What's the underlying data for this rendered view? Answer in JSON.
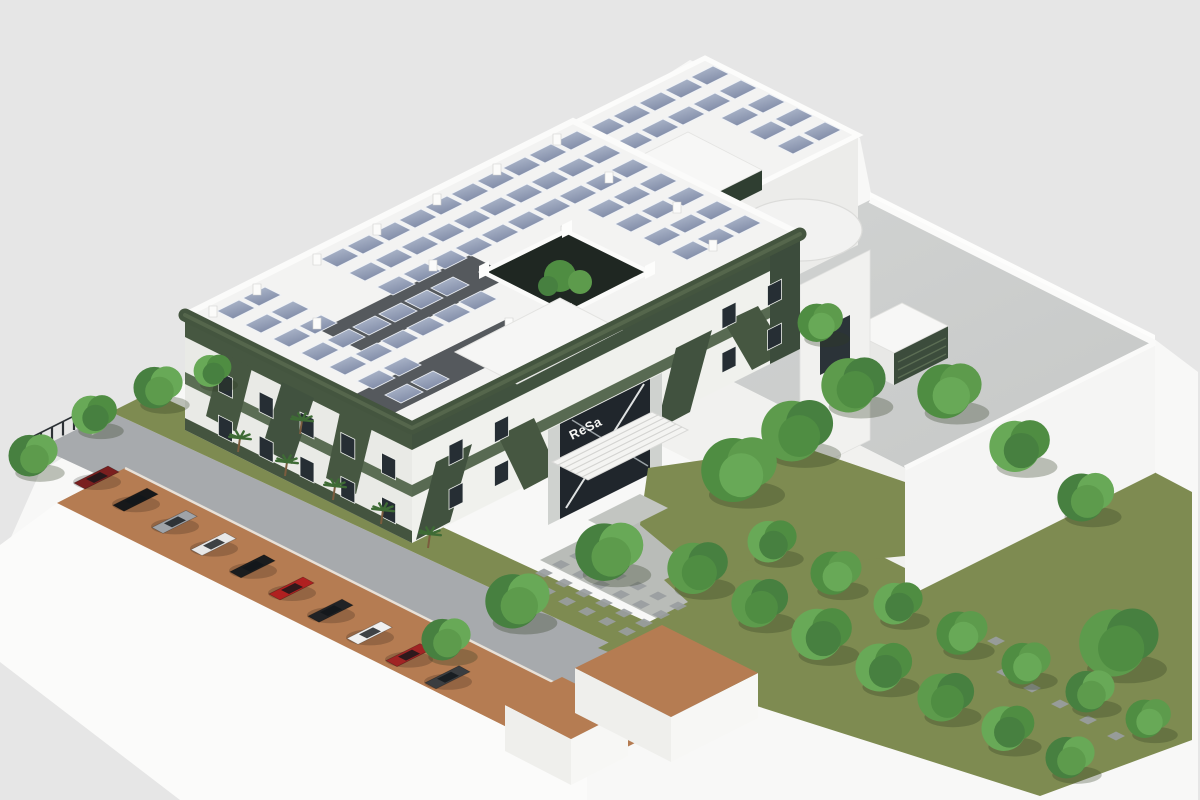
{
  "scene": {
    "type": "3d-architectural-rendering",
    "view": "isometric-aerial",
    "description": "Isometric aerial rendering of a two-story eco office building with a dark-green lattice facade, rooftop photovoltaic array, central courtyard atrium, flat-roof terrace annex, tree-lined lawns, stepping-stone paths and a parking strip under a terracotta canopy",
    "background_color": "#e6e6e6",
    "ground_color": "#f8f8f7"
  },
  "building": {
    "sign_text": "ReSa",
    "floors_visible": 2,
    "facade_green": "#41523f",
    "facade_green_light": "#5b6d54",
    "wall_white": "#f0f1ed",
    "roof_white": "#f3f3f2",
    "dark_roof_strip": "#55595d",
    "glass_dark": "#262e34",
    "parapet_white": "#fbfbfa"
  },
  "solar": {
    "frame_color": "#eef1f6",
    "cell_light": "#b6c0d2",
    "cell_dark": "#7e89a5",
    "grids": [
      {
        "id": "main",
        "origin": [
          573,
          121
        ],
        "a_rows": [
          6,
          20,
          34,
          48,
          62,
          76,
          90
        ],
        "b_start": 4,
        "b_end": 180,
        "b_step": 13,
        "pw": 11,
        "pd": 8,
        "skips": [
          {
            "a": [
              45,
              100
            ],
            "b": [
              48,
              106
            ]
          },
          {
            "a": [
              76,
              118
            ],
            "b": [
              86,
              152
            ]
          },
          {
            "a": [
              0,
              40
            ],
            "b": [
              138,
              152
            ]
          }
        ]
      },
      {
        "id": "wing",
        "origin": [
          705,
          58
        ],
        "a_rows": [
          6,
          20,
          34,
          48,
          62
        ],
        "b_start": 2,
        "b_end": 72,
        "b_step": 13,
        "pw": 11,
        "pd": 8,
        "skips": [
          {
            "a": [
              28,
              75
            ],
            "b": [
              36,
              84
            ]
          }
        ]
      }
    ]
  },
  "terrace": {
    "deck_color": "#cdcfce",
    "louver_color": "#3c4c3c",
    "wall_color": "#f5f5f4"
  },
  "landscape": {
    "lawn_color": "#7e8b51",
    "paving_color": "#a7aaad",
    "forecourt_color": "#b9bcb8",
    "canopy_color": "#b57c52",
    "stone_color": "#999da0",
    "tree_greens": [
      "#5d9b4c",
      "#4f8d42",
      "#68a957",
      "#478040"
    ],
    "tree_shadow": "#2f3b22",
    "trunk_color": "#7b5c3e",
    "palm_green": "#3e6b35"
  },
  "trees": [
    [
      35,
      470,
      26
    ],
    [
      96,
      428,
      24
    ],
    [
      160,
      402,
      26
    ],
    [
      214,
      382,
      20
    ],
    [
      742,
      492,
      40
    ],
    [
      800,
      452,
      38
    ],
    [
      856,
      404,
      34
    ],
    [
      822,
      336,
      24
    ],
    [
      612,
      572,
      36
    ],
    [
      520,
      620,
      34
    ],
    [
      448,
      654,
      26
    ],
    [
      700,
      586,
      32
    ],
    [
      762,
      620,
      30
    ],
    [
      824,
      652,
      32
    ],
    [
      886,
      684,
      30
    ],
    [
      948,
      714,
      30
    ],
    [
      1010,
      744,
      28
    ],
    [
      1072,
      772,
      26
    ],
    [
      774,
      556,
      26
    ],
    [
      838,
      588,
      27
    ],
    [
      900,
      618,
      26
    ],
    [
      964,
      648,
      27
    ],
    [
      1028,
      678,
      26
    ],
    [
      1092,
      706,
      26
    ],
    [
      1150,
      732,
      24
    ],
    [
      952,
      410,
      34
    ],
    [
      1022,
      464,
      32
    ],
    [
      1088,
      514,
      30
    ],
    [
      1122,
      666,
      42
    ]
  ],
  "palms": [
    [
      238,
      452
    ],
    [
      285,
      476
    ],
    [
      333,
      500
    ],
    [
      381,
      524
    ],
    [
      428,
      548
    ],
    [
      300,
      434
    ]
  ],
  "cars": {
    "start": [
      95,
      478
    ],
    "step": [
      39,
      22.2
    ],
    "colors": [
      "#7a1f1f",
      "#17181a",
      "#9fa3a8",
      "#e8e8e8",
      "#1a1c1e",
      "#b02020",
      "#202225",
      "#f0f0f0",
      "#a02424",
      "#3a3d40"
    ]
  },
  "windows": {
    "sw": {
      "p0": [
        196,
        326
      ],
      "p1": [
        400,
        428
      ],
      "slope": 0.5,
      "w": 14,
      "h": 20,
      "rows": [
        {
          "dy": 34,
          "n": 5
        },
        {
          "dy": 78,
          "n": 5
        }
      ]
    },
    "se": {
      "p0": [
        424,
        424
      ],
      "p1": [
        788,
        242
      ],
      "slope": -0.5,
      "w": 14,
      "h": 20,
      "rows": [
        {
          "dy": 34,
          "n": 8
        },
        {
          "dy": 78,
          "n": 8
        }
      ],
      "skip_x": [
        536,
        688
      ]
    }
  },
  "entrance": {
    "awning": {
      "p0": [
        552,
        462
      ],
      "p1": [
        652,
        412
      ],
      "off": [
        36,
        18
      ],
      "slats": 6
    }
  },
  "roof_posts": [
    [
      8,
      16
    ],
    [
      8,
      46
    ],
    [
      8,
      76
    ],
    [
      8,
      106
    ],
    [
      8,
      136
    ],
    [
      8,
      166
    ],
    [
      8,
      188
    ],
    [
      40,
      22
    ],
    [
      40,
      110
    ],
    [
      40,
      168
    ],
    [
      72,
      20
    ],
    [
      56,
      60
    ],
    [
      88,
      120
    ],
    [
      100,
      30
    ]
  ],
  "stones": {
    "forecourt": {
      "origin": [
        578,
        556
      ],
      "cols": 6,
      "col_step": [
        20,
        10
      ],
      "rows": 4,
      "row_step": [
        -17,
        8.5
      ]
    },
    "path": [
      [
        1005,
        672
      ],
      [
        1032,
        688
      ],
      [
        1060,
        704
      ],
      [
        1088,
        720
      ],
      [
        996,
        641
      ],
      [
        1116,
        736
      ]
    ]
  },
  "fence": {
    "start": [
      30,
      452
    ],
    "step": [
      11,
      -5.5
    ],
    "count": 7,
    "height": 14
  }
}
